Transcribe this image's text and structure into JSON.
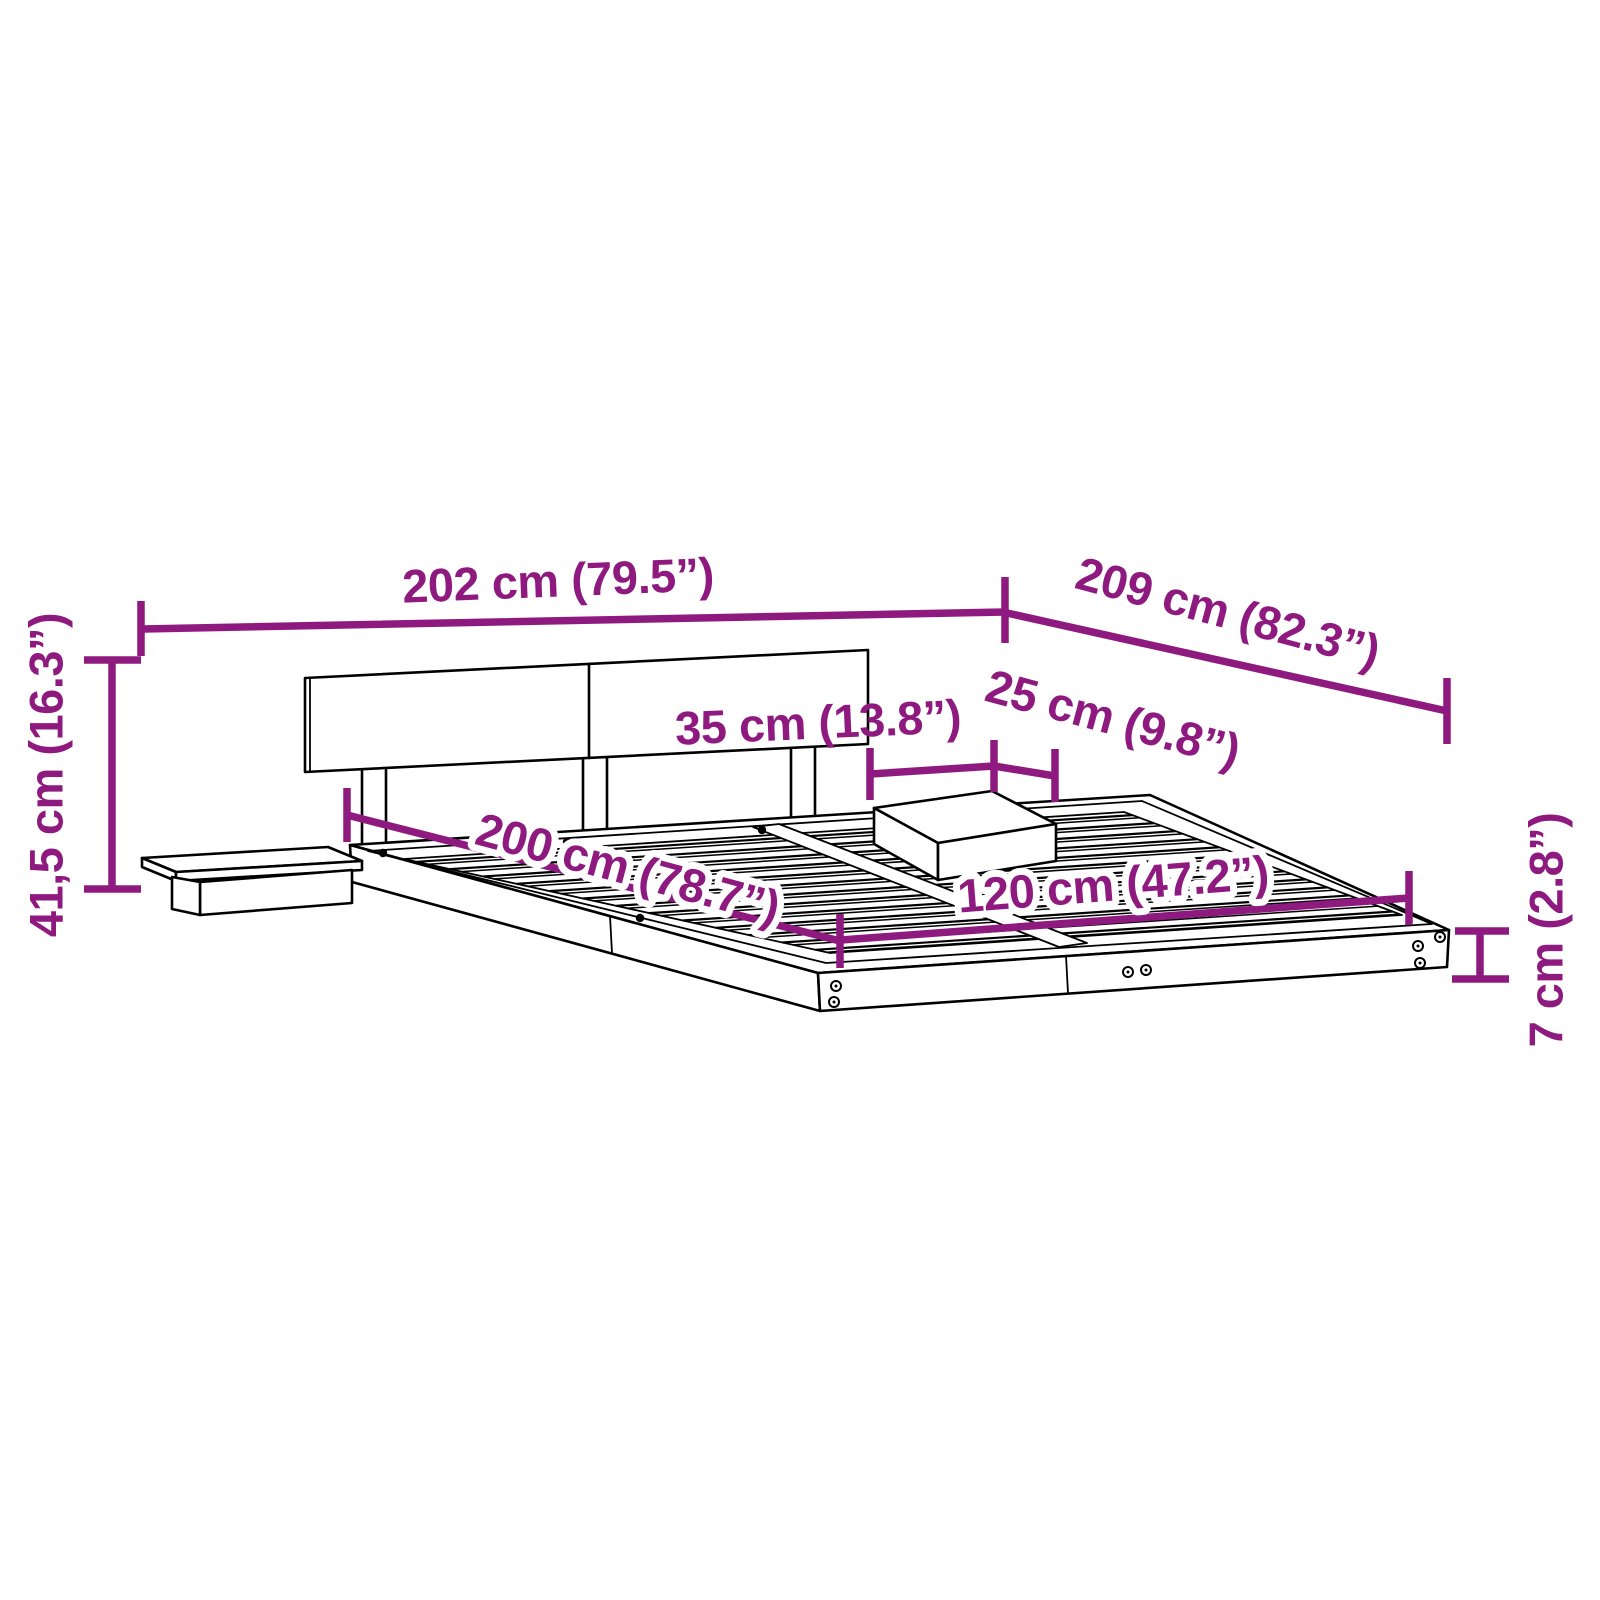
{
  "title": "Bed frame with headboard and floating side tables — dimension diagram",
  "colors": {
    "dimension_accent": "#8E1A80",
    "drawing_line": "#000000",
    "background": "#FFFFFF"
  },
  "dimensions": {
    "total_width": "202 cm (79.5”)",
    "total_depth": "209 cm (82.3”)",
    "headboard_height": "41,5 cm (16.3”)",
    "side_table_width": "35 cm (13.8”)",
    "side_table_depth": "25 cm (9.8”)",
    "bed_length": "200 cm (78.7”)",
    "bed_width": "120 cm (47.2”)",
    "platform_height": "7 cm (2.8”)"
  }
}
